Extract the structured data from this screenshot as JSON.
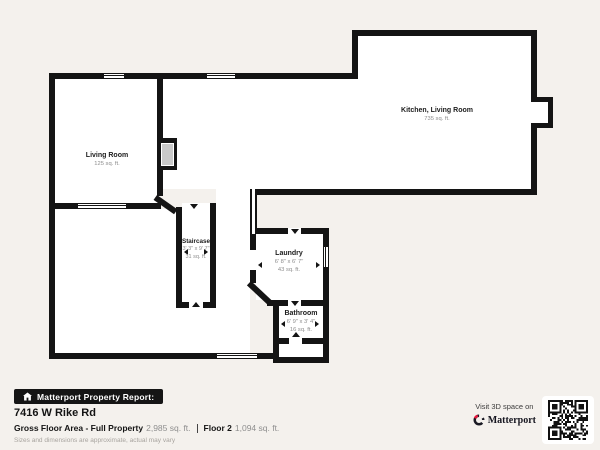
{
  "floorplan": {
    "rooms": [
      {
        "name": "Living Room",
        "area": "125 sq. ft."
      },
      {
        "name": "Kitchen, Living Room",
        "area": "735 sq. ft."
      },
      {
        "name": "Staircase",
        "dims": "3' 3\" x 9' 7\"",
        "area": "31 sq. ft."
      },
      {
        "name": "Laundry",
        "dims": "6' 8\" x 6' 7\"",
        "area": "43 sq. ft."
      },
      {
        "name": "Bathroom",
        "dims": "6' 9\" x 3' 4\"",
        "area": "16 sq. ft."
      }
    ]
  },
  "footer": {
    "report_badge": "Matterport Property Report:",
    "address": "7416 W Rike Rd",
    "gross_label": "Gross Floor Area - Full Property",
    "gross_value": "2,985 sq. ft.",
    "floor_label": "Floor 2",
    "floor_value": "1,094 sq. ft.",
    "disclaimer": "Sizes and dimensions are approximate, actual may vary"
  },
  "cta": {
    "visit": "Visit 3D space on",
    "brand": "Matterport"
  },
  "colors": {
    "background": "#f4f1ed",
    "wall": "#141414",
    "room_fill": "#ffffff",
    "accent_red": "#e8173d",
    "muted_text": "#8d8d8d"
  }
}
